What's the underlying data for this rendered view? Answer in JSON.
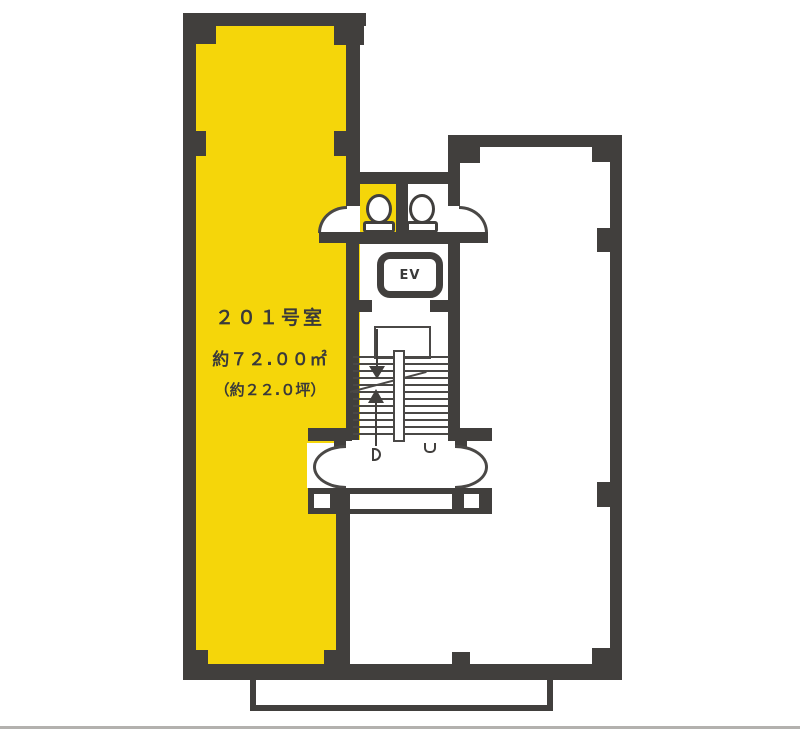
{
  "room201": {
    "label": "２０１号室",
    "area_sqm": "約７２.００㎡",
    "area_tsubo": "（約２２.０坪）"
  },
  "elevator": {
    "label": "EV"
  },
  "colors": {
    "highlight": "#F5D60A",
    "wall": "#413F3D",
    "line": "#4A4846",
    "text": "#3A3A3A",
    "scanline": "#B3B1AE",
    "background": "#FFFFFF"
  }
}
